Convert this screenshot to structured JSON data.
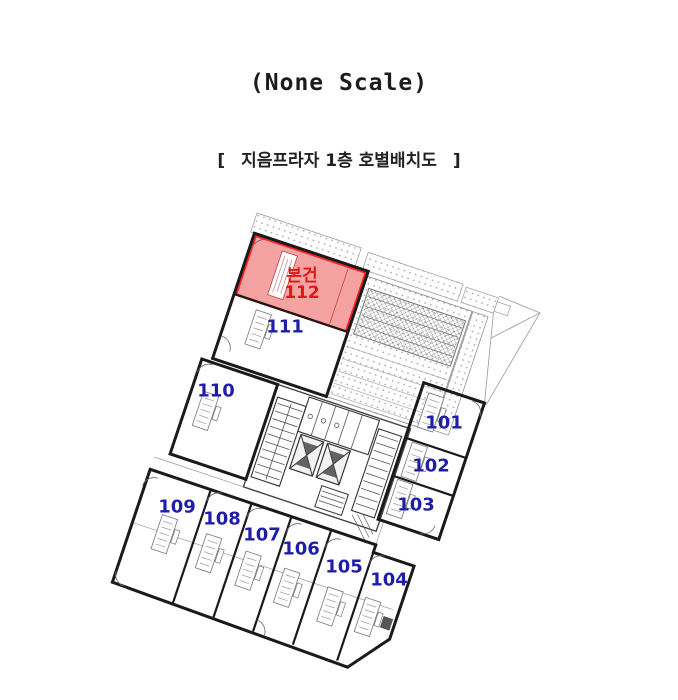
{
  "header": {
    "scale_note": "(None Scale)",
    "bracket_open": "[",
    "bracket_close": "]",
    "plan_title": "지음프라자 1층 호별배치도"
  },
  "subject": {
    "marker": "본건",
    "unit_no": "112"
  },
  "units": [
    {
      "no": "101"
    },
    {
      "no": "102"
    },
    {
      "no": "103"
    },
    {
      "no": "104"
    },
    {
      "no": "105"
    },
    {
      "no": "106"
    },
    {
      "no": "107"
    },
    {
      "no": "108"
    },
    {
      "no": "109"
    },
    {
      "no": "110"
    },
    {
      "no": "111"
    }
  ],
  "colors": {
    "unit_label": "#1e1ea8",
    "subject_text": "#e01717",
    "subject_fill": "#f4a2a2",
    "subject_border": "#ff2222",
    "wall": "#1a1a1a"
  }
}
